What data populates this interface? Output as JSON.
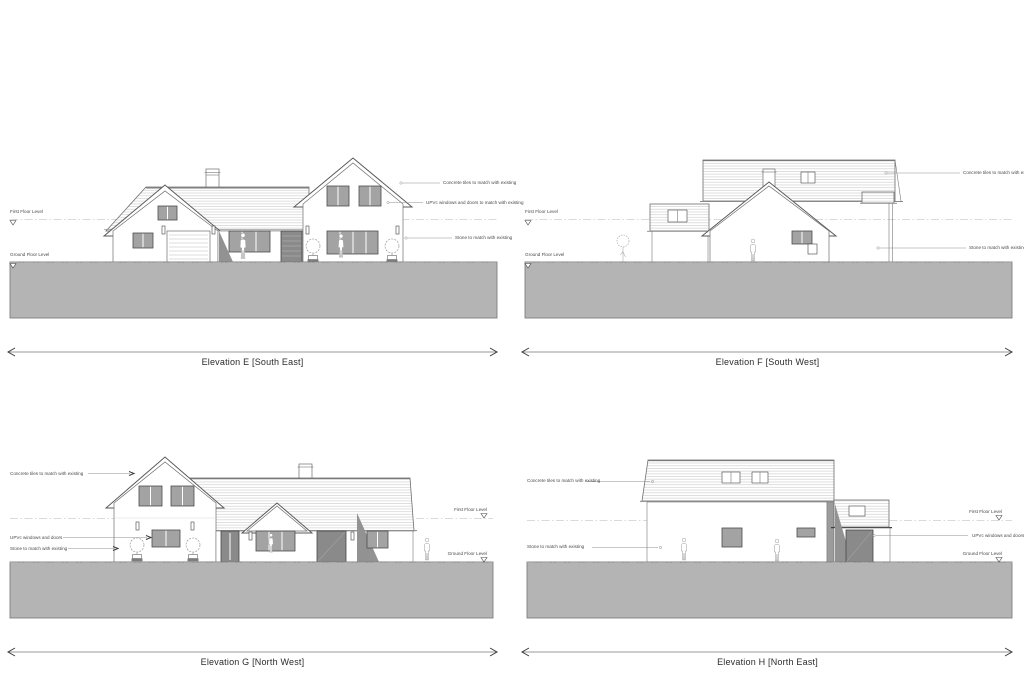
{
  "colors": {
    "ground": "#b4b4b4",
    "line": "#6e6e6e",
    "glass": "#a3a3a3",
    "shadow": "#929292"
  },
  "panels": [
    {
      "id": "E",
      "title": "Elevation E [South East]",
      "levels": {
        "first": "First Floor Level",
        "ground": "Ground Floor Level"
      },
      "annotations": [
        {
          "name": "concrete-tiles",
          "text": "Concrete tiles to match with existing"
        },
        {
          "name": "upvc",
          "text": "UPVc windows and doors to match with existing"
        },
        {
          "name": "stone",
          "text": "Stone to match with existing"
        }
      ]
    },
    {
      "id": "F",
      "title": "Elevation F [South West]",
      "levels": {
        "first": "First Floor Level",
        "ground": "Ground Floor Level"
      },
      "annotations": [
        {
          "name": "concrete-tiles",
          "text": "Concrete tiles to match with existing"
        },
        {
          "name": "stone",
          "text": "Stone to match with existing"
        }
      ]
    },
    {
      "id": "G",
      "title": "Elevation G [North West]",
      "levels": {
        "first": "First Floor Level",
        "ground": "Ground Floor Level"
      },
      "annotations": [
        {
          "name": "concrete-tiles",
          "text": "Concrete tiles to match with existing"
        },
        {
          "name": "upvc",
          "text": "UPVc windows and doors"
        },
        {
          "name": "stone",
          "text": "Stone to match with existing"
        }
      ]
    },
    {
      "id": "H",
      "title": "Elevation H [North East]",
      "levels": {
        "first": "First Floor Level",
        "ground": "Ground Floor Level"
      },
      "annotations": [
        {
          "name": "concrete-tiles",
          "text": "Concrete tiles to match with existing"
        },
        {
          "name": "stone",
          "text": "Stone to match with existing"
        },
        {
          "name": "upvc",
          "text": "UPVc windows and doors"
        }
      ]
    }
  ]
}
